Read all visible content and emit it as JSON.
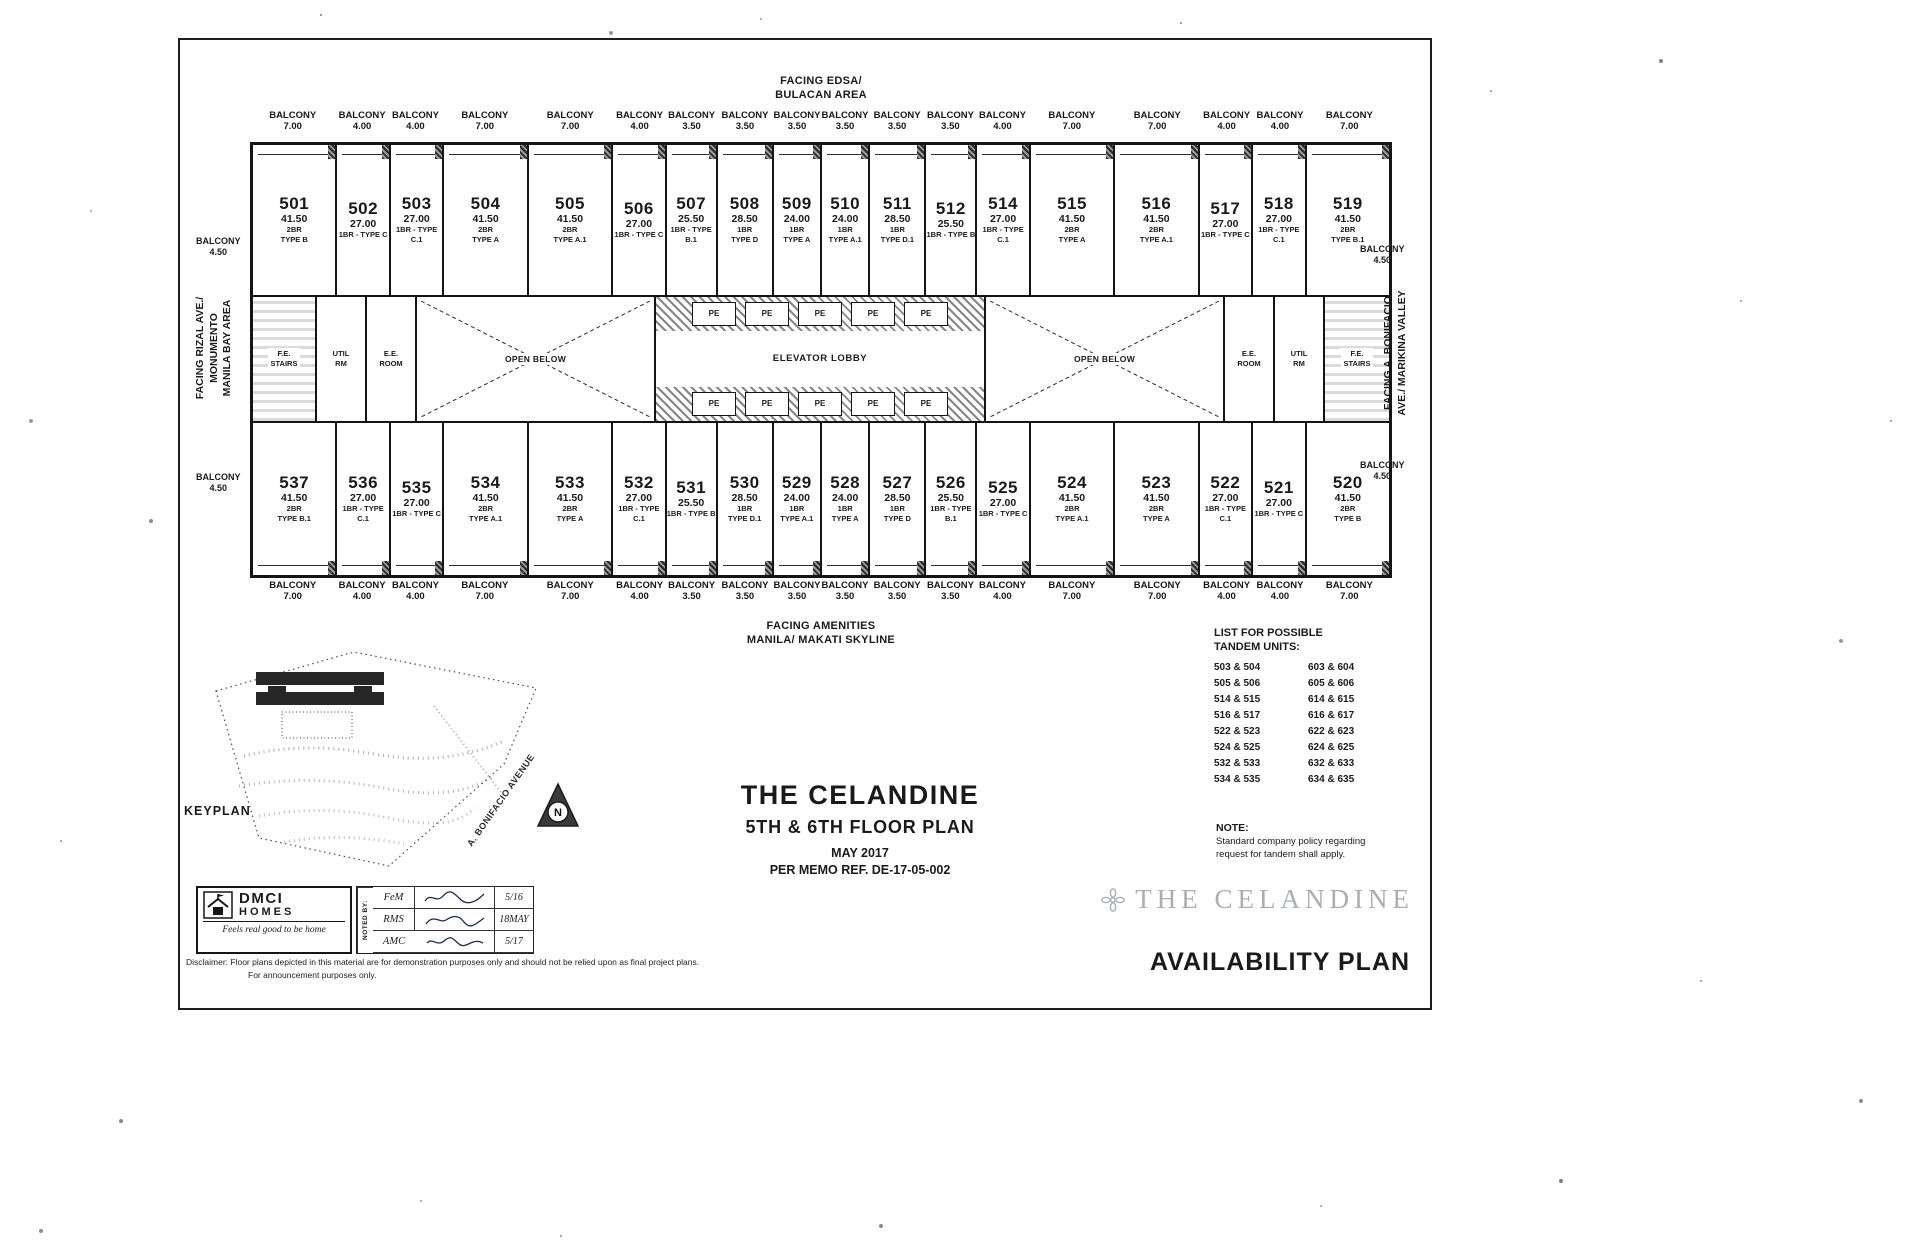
{
  "colors": {
    "ink": "#1a1a1a",
    "paper": "#ffffff",
    "watermark_gray": "#a9aeb5"
  },
  "plan": {
    "facing_top": "FACING EDSA/\nBULACAN AREA",
    "facing_bottom": "FACING AMENITIES\nMANILA/ MAKATI SKYLINE",
    "facing_left": "FACING RIZAL AVE./\nMONUMENTO\nMANILA BAY AREA",
    "facing_right": "FACING A. BONIFACIO\nAVE./ MARIKINA VALLEY",
    "balcony_word": "BALCONY",
    "corner_balcony": {
      "label": "BALCONY",
      "value": "4.50"
    },
    "top_balconies": [
      {
        "v": "7.00",
        "w": 1.6
      },
      {
        "v": "4.00",
        "w": 1
      },
      {
        "v": "4.00",
        "w": 1
      },
      {
        "v": "7.00",
        "w": 1.6
      },
      {
        "v": "7.00",
        "w": 1.6
      },
      {
        "v": "4.00",
        "w": 1
      },
      {
        "v": "3.50",
        "w": 0.95
      },
      {
        "v": "3.50",
        "w": 1.05
      },
      {
        "v": "3.50",
        "w": 0.9
      },
      {
        "v": "3.50",
        "w": 0.9
      },
      {
        "v": "3.50",
        "w": 1.05
      },
      {
        "v": "3.50",
        "w": 0.95
      },
      {
        "v": "4.00",
        "w": 1
      },
      {
        "v": "7.00",
        "w": 1.6
      },
      {
        "v": "7.00",
        "w": 1.6
      },
      {
        "v": "4.00",
        "w": 1
      },
      {
        "v": "4.00",
        "w": 1
      },
      {
        "v": "7.00",
        "w": 1.6
      }
    ],
    "bottom_balconies": [
      {
        "v": "7.00",
        "w": 1.6
      },
      {
        "v": "4.00",
        "w": 1
      },
      {
        "v": "4.00",
        "w": 1
      },
      {
        "v": "7.00",
        "w": 1.6
      },
      {
        "v": "7.00",
        "w": 1.6
      },
      {
        "v": "4.00",
        "w": 1
      },
      {
        "v": "3.50",
        "w": 0.95
      },
      {
        "v": "3.50",
        "w": 1.05
      },
      {
        "v": "3.50",
        "w": 0.9
      },
      {
        "v": "3.50",
        "w": 0.9
      },
      {
        "v": "3.50",
        "w": 1.05
      },
      {
        "v": "3.50",
        "w": 0.95
      },
      {
        "v": "4.00",
        "w": 1
      },
      {
        "v": "7.00",
        "w": 1.6
      },
      {
        "v": "7.00",
        "w": 1.6
      },
      {
        "v": "4.00",
        "w": 1
      },
      {
        "v": "4.00",
        "w": 1
      },
      {
        "v": "7.00",
        "w": 1.6
      }
    ],
    "top_units": [
      {
        "no": "501",
        "area": "41.50",
        "t1": "2BR",
        "t2": "TYPE B",
        "w": 1.6
      },
      {
        "no": "502",
        "area": "27.00",
        "t1": "1BR - TYPE C",
        "t2": "",
        "w": 1
      },
      {
        "no": "503",
        "area": "27.00",
        "t1": "1BR - TYPE C.1",
        "t2": "",
        "w": 1
      },
      {
        "no": "504",
        "area": "41.50",
        "t1": "2BR",
        "t2": "TYPE A",
        "w": 1.6
      },
      {
        "no": "505",
        "area": "41.50",
        "t1": "2BR",
        "t2": "TYPE A.1",
        "w": 1.6
      },
      {
        "no": "506",
        "area": "27.00",
        "t1": "1BR - TYPE C",
        "t2": "",
        "w": 1
      },
      {
        "no": "507",
        "area": "25.50",
        "t1": "1BR - TYPE B.1",
        "t2": "",
        "w": 0.95
      },
      {
        "no": "508",
        "area": "28.50",
        "t1": "1BR",
        "t2": "TYPE D",
        "w": 1.05
      },
      {
        "no": "509",
        "area": "24.00",
        "t1": "1BR",
        "t2": "TYPE A",
        "w": 0.9
      },
      {
        "no": "510",
        "area": "24.00",
        "t1": "1BR",
        "t2": "TYPE A.1",
        "w": 0.9
      },
      {
        "no": "511",
        "area": "28.50",
        "t1": "1BR",
        "t2": "TYPE D.1",
        "w": 1.05
      },
      {
        "no": "512",
        "area": "25.50",
        "t1": "1BR - TYPE B",
        "t2": "",
        "w": 0.95
      },
      {
        "no": "514",
        "area": "27.00",
        "t1": "1BR - TYPE C.1",
        "t2": "",
        "w": 1
      },
      {
        "no": "515",
        "area": "41.50",
        "t1": "2BR",
        "t2": "TYPE A",
        "w": 1.6
      },
      {
        "no": "516",
        "area": "41.50",
        "t1": "2BR",
        "t2": "TYPE A.1",
        "w": 1.6
      },
      {
        "no": "517",
        "area": "27.00",
        "t1": "1BR - TYPE C",
        "t2": "",
        "w": 1
      },
      {
        "no": "518",
        "area": "27.00",
        "t1": "1BR - TYPE C.1",
        "t2": "",
        "w": 1
      },
      {
        "no": "519",
        "area": "41.50",
        "t1": "2BR",
        "t2": "TYPE B.1",
        "w": 1.6
      }
    ],
    "bottom_units": [
      {
        "no": "537",
        "area": "41.50",
        "t1": "2BR",
        "t2": "TYPE B.1",
        "w": 1.6
      },
      {
        "no": "536",
        "area": "27.00",
        "t1": "1BR - TYPE C.1",
        "t2": "",
        "w": 1
      },
      {
        "no": "535",
        "area": "27.00",
        "t1": "1BR - TYPE C",
        "t2": "",
        "w": 1
      },
      {
        "no": "534",
        "area": "41.50",
        "t1": "2BR",
        "t2": "TYPE A.1",
        "w": 1.6
      },
      {
        "no": "533",
        "area": "41.50",
        "t1": "2BR",
        "t2": "TYPE A",
        "w": 1.6
      },
      {
        "no": "532",
        "area": "27.00",
        "t1": "1BR - TYPE C.1",
        "t2": "",
        "w": 1
      },
      {
        "no": "531",
        "area": "25.50",
        "t1": "1BR - TYPE B",
        "t2": "",
        "w": 0.95
      },
      {
        "no": "530",
        "area": "28.50",
        "t1": "1BR",
        "t2": "TYPE D.1",
        "w": 1.05
      },
      {
        "no": "529",
        "area": "24.00",
        "t1": "1BR",
        "t2": "TYPE A.1",
        "w": 0.9
      },
      {
        "no": "528",
        "area": "24.00",
        "t1": "1BR",
        "t2": "TYPE A",
        "w": 0.9
      },
      {
        "no": "527",
        "area": "28.50",
        "t1": "1BR",
        "t2": "TYPE D",
        "w": 1.05
      },
      {
        "no": "526",
        "area": "25.50",
        "t1": "1BR - TYPE B.1",
        "t2": "",
        "w": 0.95
      },
      {
        "no": "525",
        "area": "27.00",
        "t1": "1BR - TYPE C",
        "t2": "",
        "w": 1
      },
      {
        "no": "524",
        "area": "41.50",
        "t1": "2BR",
        "t2": "TYPE A.1",
        "w": 1.6
      },
      {
        "no": "523",
        "area": "41.50",
        "t1": "2BR",
        "t2": "TYPE A",
        "w": 1.6
      },
      {
        "no": "522",
        "area": "27.00",
        "t1": "1BR - TYPE C.1",
        "t2": "",
        "w": 1
      },
      {
        "no": "521",
        "area": "27.00",
        "t1": "1BR - TYPE C",
        "t2": "",
        "w": 1
      },
      {
        "no": "520",
        "area": "41.50",
        "t1": "2BR",
        "t2": "TYPE B",
        "w": 1.6
      }
    ],
    "core": {
      "fe_stairs": "F.E.\nSTAIRS",
      "util_rm": "UTIL\nRM",
      "ee_room": "E.E.\nROOM",
      "open_below": "OPEN BELOW",
      "elevator_lobby": "ELEVATOR LOBBY",
      "pe_top": [
        "PE",
        "PE",
        "PE",
        "PE",
        "PE"
      ],
      "pe_bottom": [
        "PE",
        "PE",
        "PE",
        "PE",
        "PE"
      ]
    }
  },
  "keyplan": {
    "label": "KEYPLAN",
    "street": "A. BONIFACIO AVENUE",
    "north": "N"
  },
  "titleblock": {
    "project": "THE CELANDINE",
    "plan": "5TH & 6TH FLOOR PLAN",
    "date": "MAY 2017",
    "memo": "PER MEMO REF. DE-17-05-002"
  },
  "tandem": {
    "title": "LIST FOR POSSIBLE\nTANDEM UNITS:",
    "pairs": [
      [
        "503 & 504",
        "603 & 604"
      ],
      [
        "505 & 506",
        "605 & 606"
      ],
      [
        "514 & 515",
        "614 & 615"
      ],
      [
        "516 & 517",
        "616 & 617"
      ],
      [
        "522 & 523",
        "622 & 623"
      ],
      [
        "524 & 525",
        "624 & 625"
      ],
      [
        "532 & 533",
        "632 & 633"
      ],
      [
        "534 & 535",
        "634 & 635"
      ]
    ]
  },
  "note": {
    "title": "NOTE:",
    "body": "Standard company policy regarding\nrequest for tandem shall apply."
  },
  "logo": {
    "brand1": "DMCI",
    "brand2": "HOMES",
    "tagline": "Feels real good to be home"
  },
  "noted_by": {
    "label": "NOTED BY:",
    "rows": [
      {
        "initials": "FeM",
        "date": "5/16"
      },
      {
        "initials": "RMS",
        "date": "18MAY"
      },
      {
        "initials": "AMC",
        "date": "5/17"
      }
    ]
  },
  "disclaimer": {
    "line1": "Disclaimer:   Floor plans depicted in this material are for demonstration purposes only and should not be relied upon as final project plans.",
    "line2": "For announcement purposes only."
  },
  "footer": {
    "watermark": "THE CELANDINE",
    "availability": "AVAILABILITY PLAN"
  }
}
